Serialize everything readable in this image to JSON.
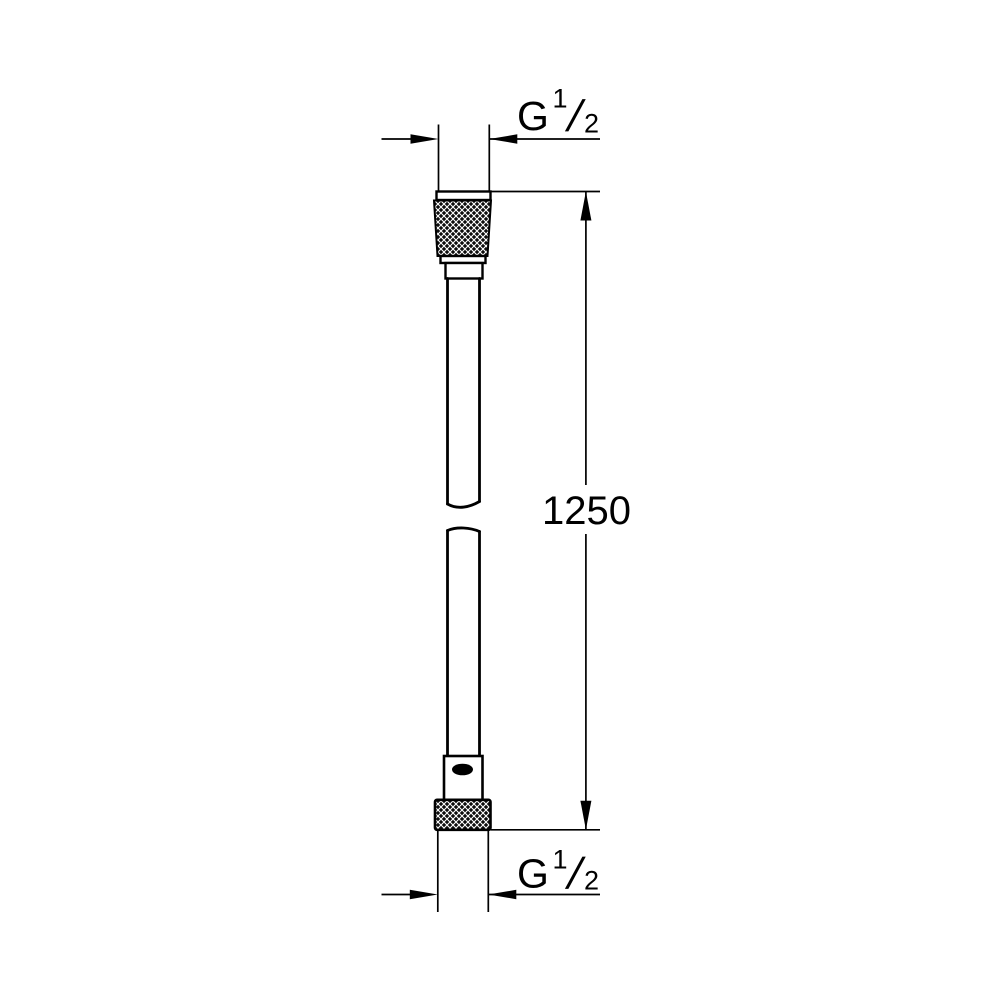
{
  "drawing": {
    "type": "technical-dimension-drawing",
    "subject": "shower-hose",
    "hose_length": {
      "value": "1250"
    },
    "thread_labels": {
      "top": {
        "base": "G",
        "numerator": "1",
        "fraction_slash": "/",
        "denominator": "2"
      },
      "bottom": {
        "base": "G",
        "numerator": "1",
        "fraction_slash": "/",
        "denominator": "2"
      }
    },
    "colors": {
      "line": "#000000",
      "background": "#ffffff",
      "knurl_fill": "#0d0d0d",
      "knurl_lattice": "#ffffff"
    }
  }
}
